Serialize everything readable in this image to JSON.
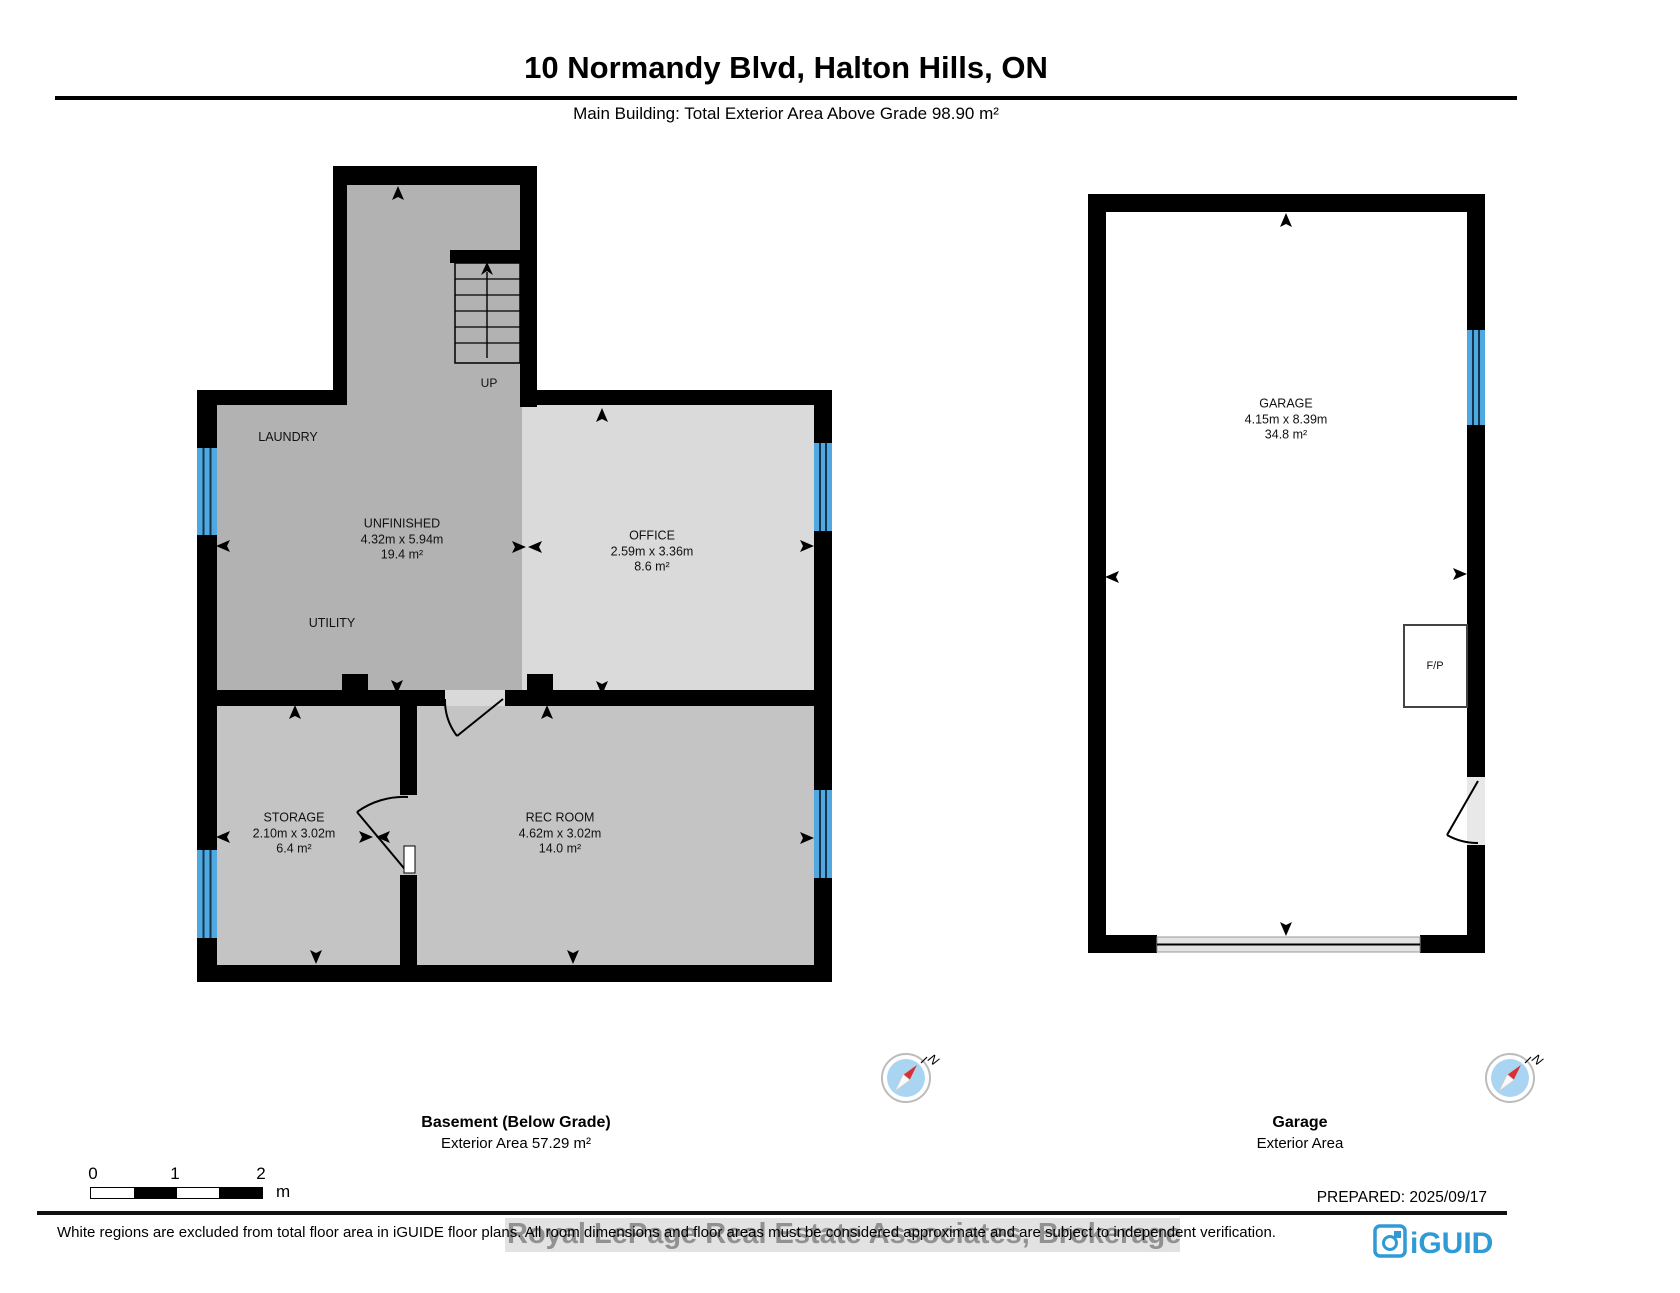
{
  "header": {
    "title": "10 Normandy Blvd, Halton Hills, ON",
    "subtitle": "Main Building: Total Exterior Area Above Grade 98.90 m²"
  },
  "basement": {
    "caption": {
      "name": "Basement (Below Grade)",
      "area": "Exterior Area 57.29 m²"
    },
    "stairs_label": "UP",
    "rooms": [
      {
        "name": "LAUNDRY"
      },
      {
        "name": "UNFINISHED",
        "dims": "4.32m x 5.94m",
        "area": "19.4 m²"
      },
      {
        "name": "UTILITY"
      },
      {
        "name": "OFFICE",
        "dims": "2.59m x 3.36m",
        "area": "8.6 m²"
      },
      {
        "name": "STORAGE",
        "dims": "2.10m x 3.02m",
        "area": "6.4 m²"
      },
      {
        "name": "REC ROOM",
        "dims": "4.62m x 3.02m",
        "area": "14.0 m²"
      }
    ]
  },
  "garage": {
    "caption": {
      "name": "Garage",
      "area": "Exterior Area"
    },
    "room": {
      "name": "GARAGE",
      "dims": "4.15m x 8.39m",
      "area": "34.8 m²"
    },
    "fireplace_label": "F/P"
  },
  "compass": {
    "label": "N"
  },
  "scale_bar": {
    "ticks": [
      "0",
      "1",
      "2"
    ],
    "unit": "m"
  },
  "footer": {
    "prepared": "PREPARED: 2025/09/17",
    "disclaimer": "White regions are excluded from total floor area in iGUIDE floor plans. All room dimensions and floor areas must be considered approximate and are subject to independent verification.",
    "watermark": "Royal LePage Real Estate Associates, Brokerage",
    "brand": "iGUIDE"
  },
  "colors": {
    "wall": "#000000",
    "window": "#4fa9e0",
    "room_dark": "#b2b2b2",
    "room_medium": "#c4c4c4",
    "room_light": "#dadada",
    "garage_door": "#e3e3e3",
    "brand_blue": "#2e9ad6",
    "compass_fill": "#a9d5f2",
    "compass_needle": "#d93030"
  }
}
